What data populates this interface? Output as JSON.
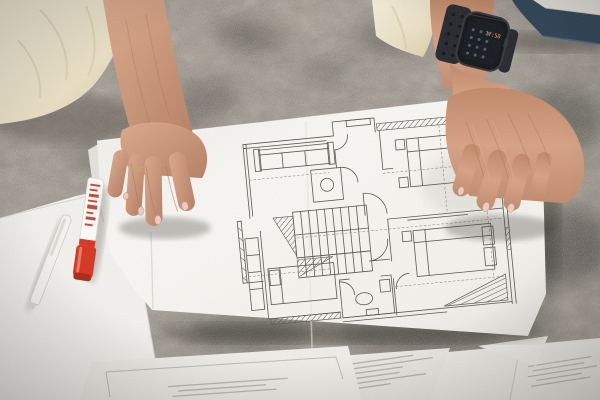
{
  "scene": {
    "description": "Overhead photo of a person kneeling on a patterned grey rug, pressing an architectural floor-plan sheet flat with both hands; a red marker, a white pen and loose printed documents lie around the plan",
    "person": {
      "clothing": "cream beige outfit",
      "right_hand": "pressing left edge of floor plan, thin ring on ring finger",
      "left_hand": "pressing right edge of floor plan, wearing black smartwatch"
    },
    "smartwatch": {
      "time": "17:58",
      "band": "black perforated sport band"
    },
    "floor_plan": {
      "label": "architectural-floor-plan",
      "features": [
        "sofa",
        "staircase",
        "beds with pillows",
        "toilet room",
        "bathroom",
        "door swing arcs",
        "hatched walls",
        "dashed guide lines"
      ]
    },
    "marker": {
      "label": "red-marker",
      "body": "white barrel with red print",
      "cap": "red cap facing bottom"
    },
    "pen": {
      "label": "white-pen"
    },
    "papers": {
      "label": "printed-documents",
      "note": "small illegible printed text lines"
    },
    "folder": {
      "label": "navy-folder-with-papers",
      "position": "top-right corner"
    },
    "rug": {
      "label": "patterned-rug"
    }
  },
  "colors": {
    "rug_base": "#9a9286",
    "rug_dark": "#49453e",
    "rug_light": "#b9b2a4",
    "paper": "#f6f5f1",
    "plan_line": "#55544d",
    "skin": "#c9957c",
    "fabric": "#ebe1c9",
    "marker_red": "#d6341f",
    "navy": "#2e4459",
    "watch_body": "#111418",
    "watch_time": "#ffa04a",
    "nail": "#eccdbf"
  }
}
